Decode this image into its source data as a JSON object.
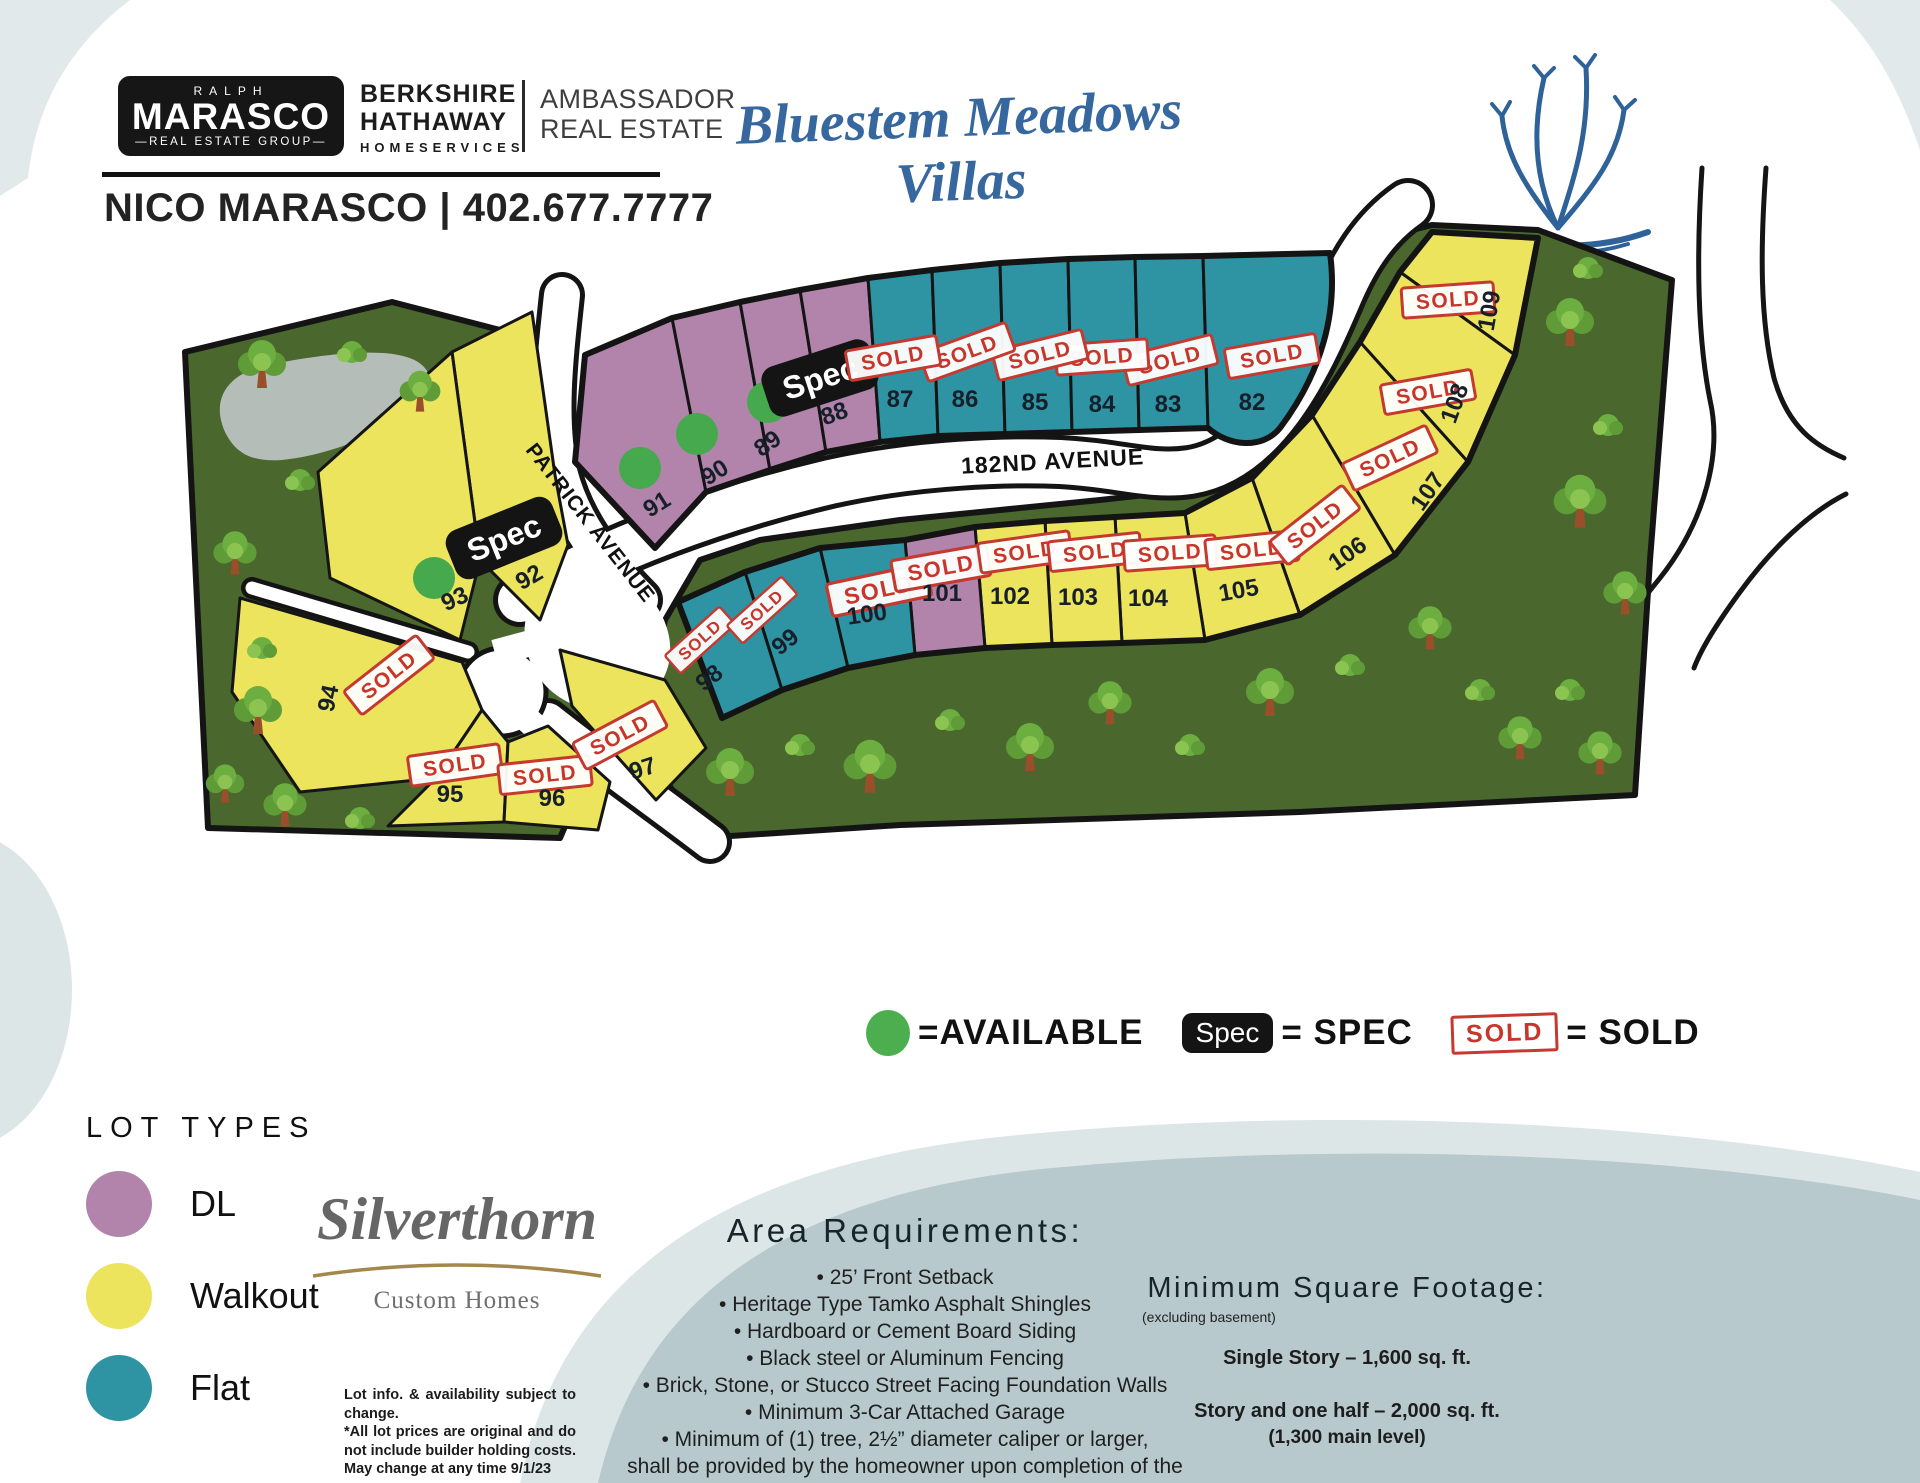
{
  "header": {
    "badge": {
      "top": "RALPH",
      "name": "MARASCO",
      "bottom": "—REAL ESTATE GROUP—"
    },
    "brokerage": {
      "l1": "BERKSHIRE",
      "l2": "HATHAWAY",
      "l3": "HOMESERVICES"
    },
    "affiliate": {
      "l1": "AMBASSADOR",
      "l2": "REAL ESTATE"
    },
    "agent": "NICO MARASCO | 402.677.7777",
    "community": "Bluestem Meadows Villas"
  },
  "labels": {
    "sold": "SOLD",
    "spec": "Spec"
  },
  "map": {
    "streets": {
      "avenue": "182ND AVENUE",
      "patrick": "PATRICK AVENUE"
    },
    "lots": [
      {
        "number": "82",
        "type": "Flat",
        "status": "sold"
      },
      {
        "number": "83",
        "type": "Flat",
        "status": "sold"
      },
      {
        "number": "84",
        "type": "Flat",
        "status": "sold"
      },
      {
        "number": "85",
        "type": "Flat",
        "status": "sold"
      },
      {
        "number": "86",
        "type": "Flat",
        "status": "sold"
      },
      {
        "number": "87",
        "type": "Flat",
        "status": "sold"
      },
      {
        "number": "88",
        "type": "DL",
        "status": "spec"
      },
      {
        "number": "89",
        "type": "DL",
        "status": "available"
      },
      {
        "number": "90",
        "type": "DL",
        "status": "available"
      },
      {
        "number": "91",
        "type": "DL",
        "status": "available"
      },
      {
        "number": "92",
        "type": "Walkout",
        "status": "spec"
      },
      {
        "number": "93",
        "type": "Walkout",
        "status": "available"
      },
      {
        "number": "94",
        "type": "Walkout",
        "status": "sold"
      },
      {
        "number": "95",
        "type": "Walkout",
        "status": "sold"
      },
      {
        "number": "96",
        "type": "Walkout",
        "status": "sold"
      },
      {
        "number": "97",
        "type": "Walkout",
        "status": "sold"
      },
      {
        "number": "98",
        "type": "Flat",
        "status": "sold"
      },
      {
        "number": "99",
        "type": "Flat",
        "status": "sold"
      },
      {
        "number": "100",
        "type": "Flat",
        "status": "sold"
      },
      {
        "number": "101",
        "type": "DL",
        "status": "sold"
      },
      {
        "number": "102",
        "type": "Walkout",
        "status": "sold"
      },
      {
        "number": "103",
        "type": "Walkout",
        "status": "sold"
      },
      {
        "number": "104",
        "type": "Walkout",
        "status": "sold"
      },
      {
        "number": "105",
        "type": "Walkout",
        "status": "sold"
      },
      {
        "number": "106",
        "type": "Walkout",
        "status": "sold"
      },
      {
        "number": "107",
        "type": "Walkout",
        "status": "sold"
      },
      {
        "number": "108",
        "type": "Walkout",
        "status": "sold"
      },
      {
        "number": "109",
        "type": "Walkout",
        "status": "sold"
      }
    ]
  },
  "legend": {
    "available": "=AVAILABLE",
    "spec_eq": "= SPEC",
    "sold_eq": "= SOLD"
  },
  "lot_types": {
    "title": "LOT TYPES",
    "items": [
      {
        "label": "DL",
        "color": "#b284ac"
      },
      {
        "label": "Walkout",
        "color": "#ebe45c"
      },
      {
        "label": "Flat",
        "color": "#2e94a4"
      }
    ]
  },
  "colors": {
    "available_green": "#4cae4f",
    "sold_red": "#c8352b",
    "title_blue": "#36689f",
    "parcel_green": "#4a682e",
    "blob_gray_blue": "#b7c9cd"
  },
  "builder": {
    "name": "Silverthorn",
    "tagline": "Custom Homes",
    "disclaimer1": "Lot info. & availability subject to change.",
    "disclaimer2": "*All lot prices are original and do not include builder holding costs. May change at any time 9/1/23"
  },
  "area_requirements": {
    "title": "Area Requirements:",
    "bullets": [
      "25’ Front Setback",
      "Heritage Type Tamko Asphalt Shingles",
      "Hardboard or Cement Board Siding",
      "Black steel or Aluminum Fencing",
      "Brick, Stone, or Stucco Street Facing Foundation Walls",
      "Minimum 3-Car Attached Garage",
      "Minimum of (1) tree, 2½” diameter caliper or larger,"
    ],
    "continuation": "shall be provided by the homeowner upon completion of the dwelling"
  },
  "square_footage": {
    "title": "Minimum Square Footage:",
    "note": "(excluding basement)",
    "line1": "Single Story – 1,600 sq. ft.",
    "line2": "Story and one half – 2,000 sq. ft.",
    "line3": "(1,300 main level)"
  }
}
